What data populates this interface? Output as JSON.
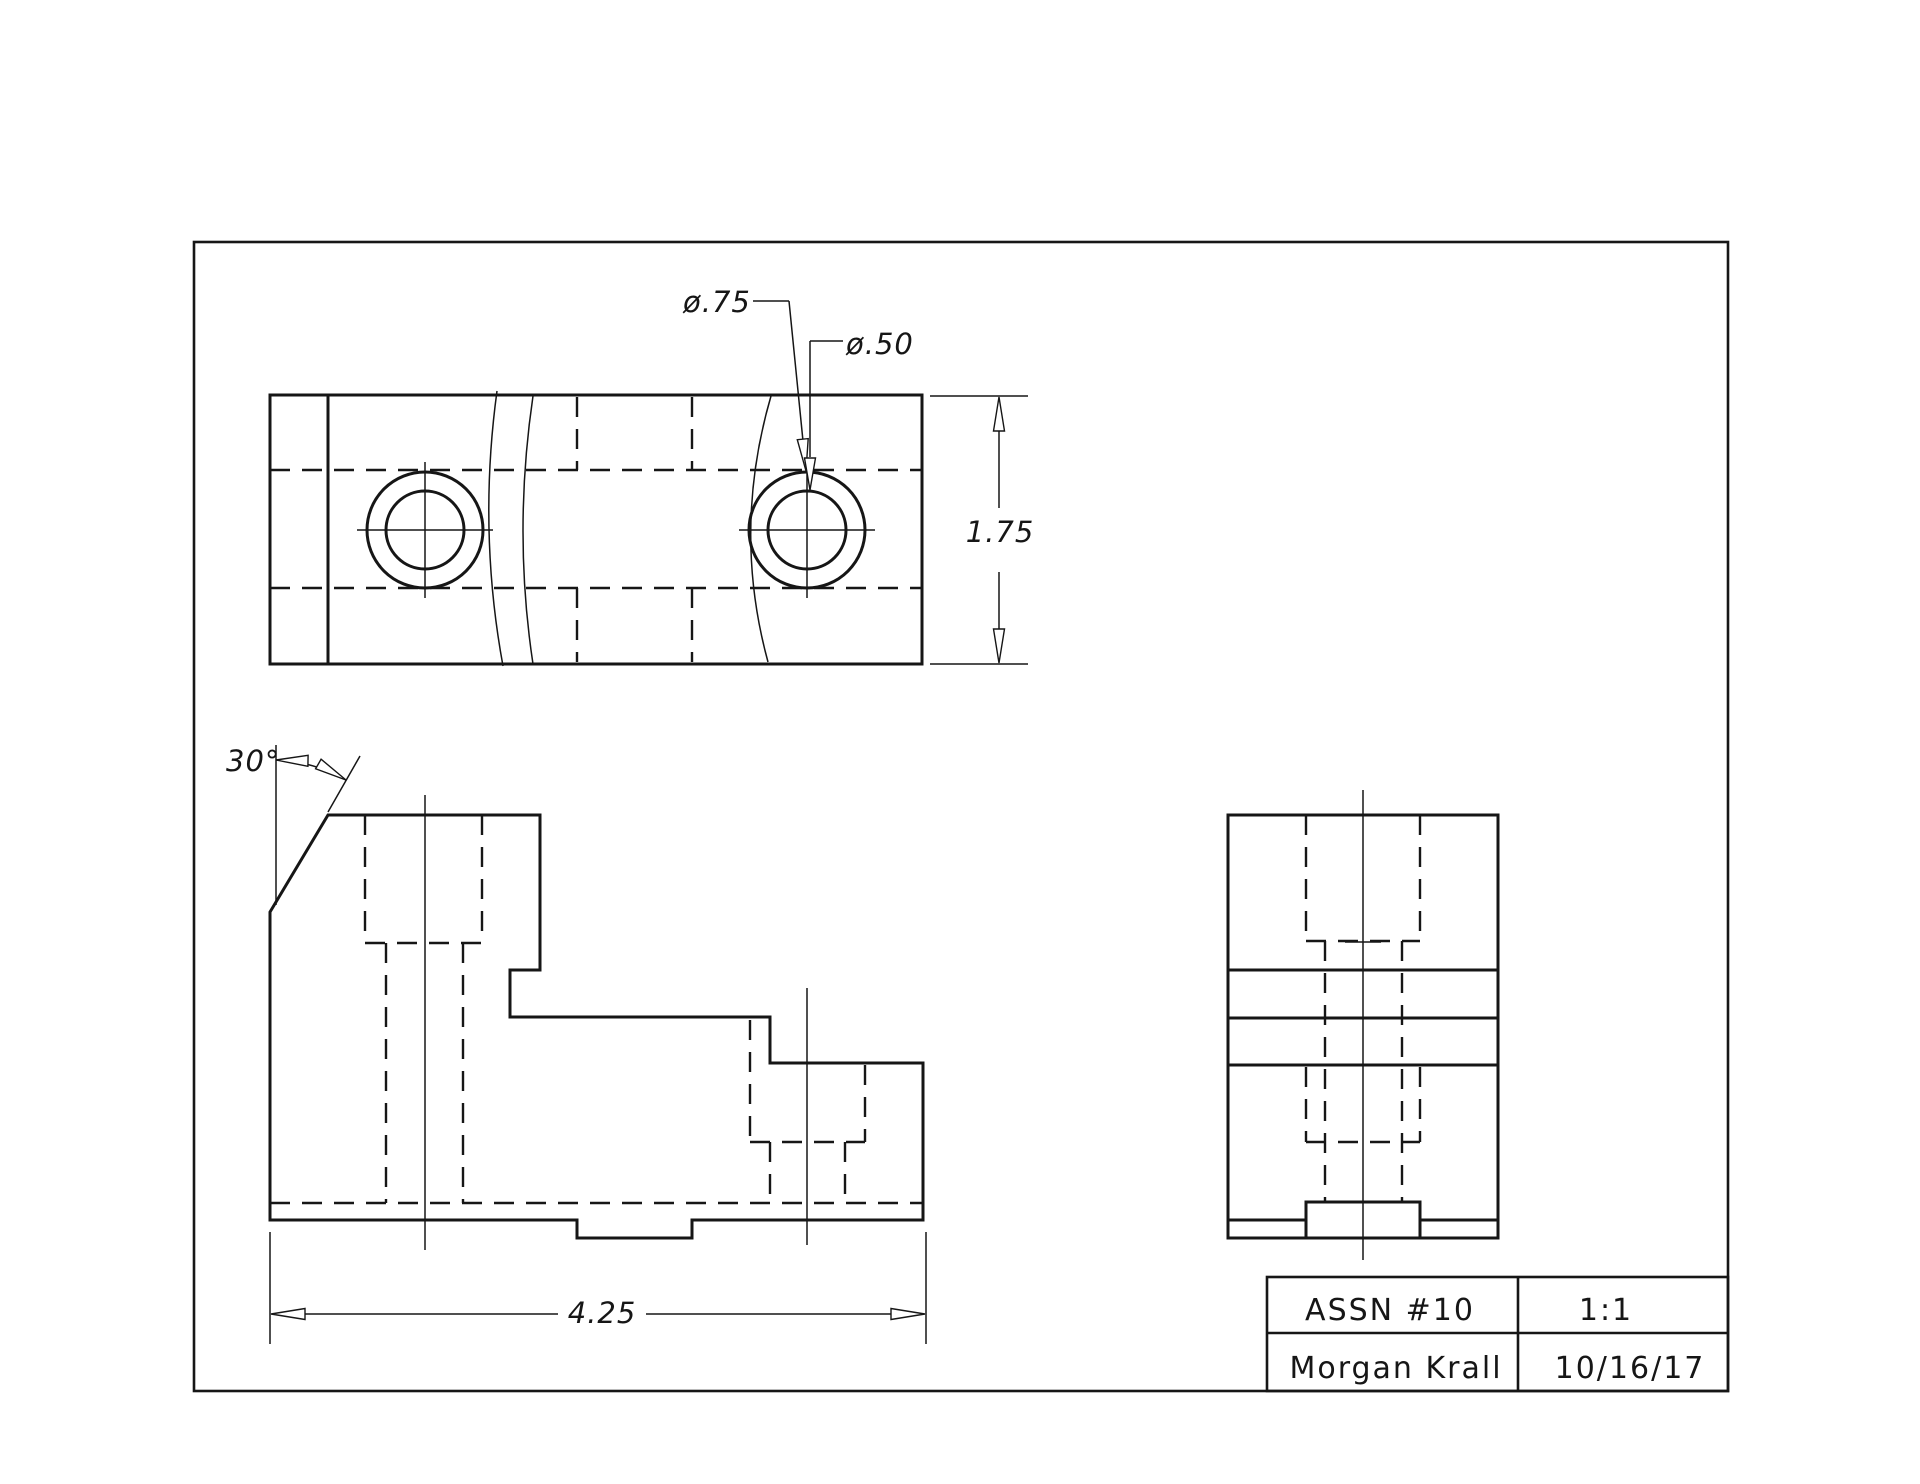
{
  "page": {
    "background": "#ffffff",
    "line_color": "#161616"
  },
  "dimensions": {
    "counterbore_diameter": "ø.75",
    "hole_diameter": "ø.50",
    "height": "1.75",
    "width": "4.25",
    "chamfer_angle": "30°"
  },
  "title_block": {
    "assignment": "ASSN  #10",
    "scale": "1:1",
    "author": "Morgan  Krall",
    "date": "10/16/17"
  }
}
